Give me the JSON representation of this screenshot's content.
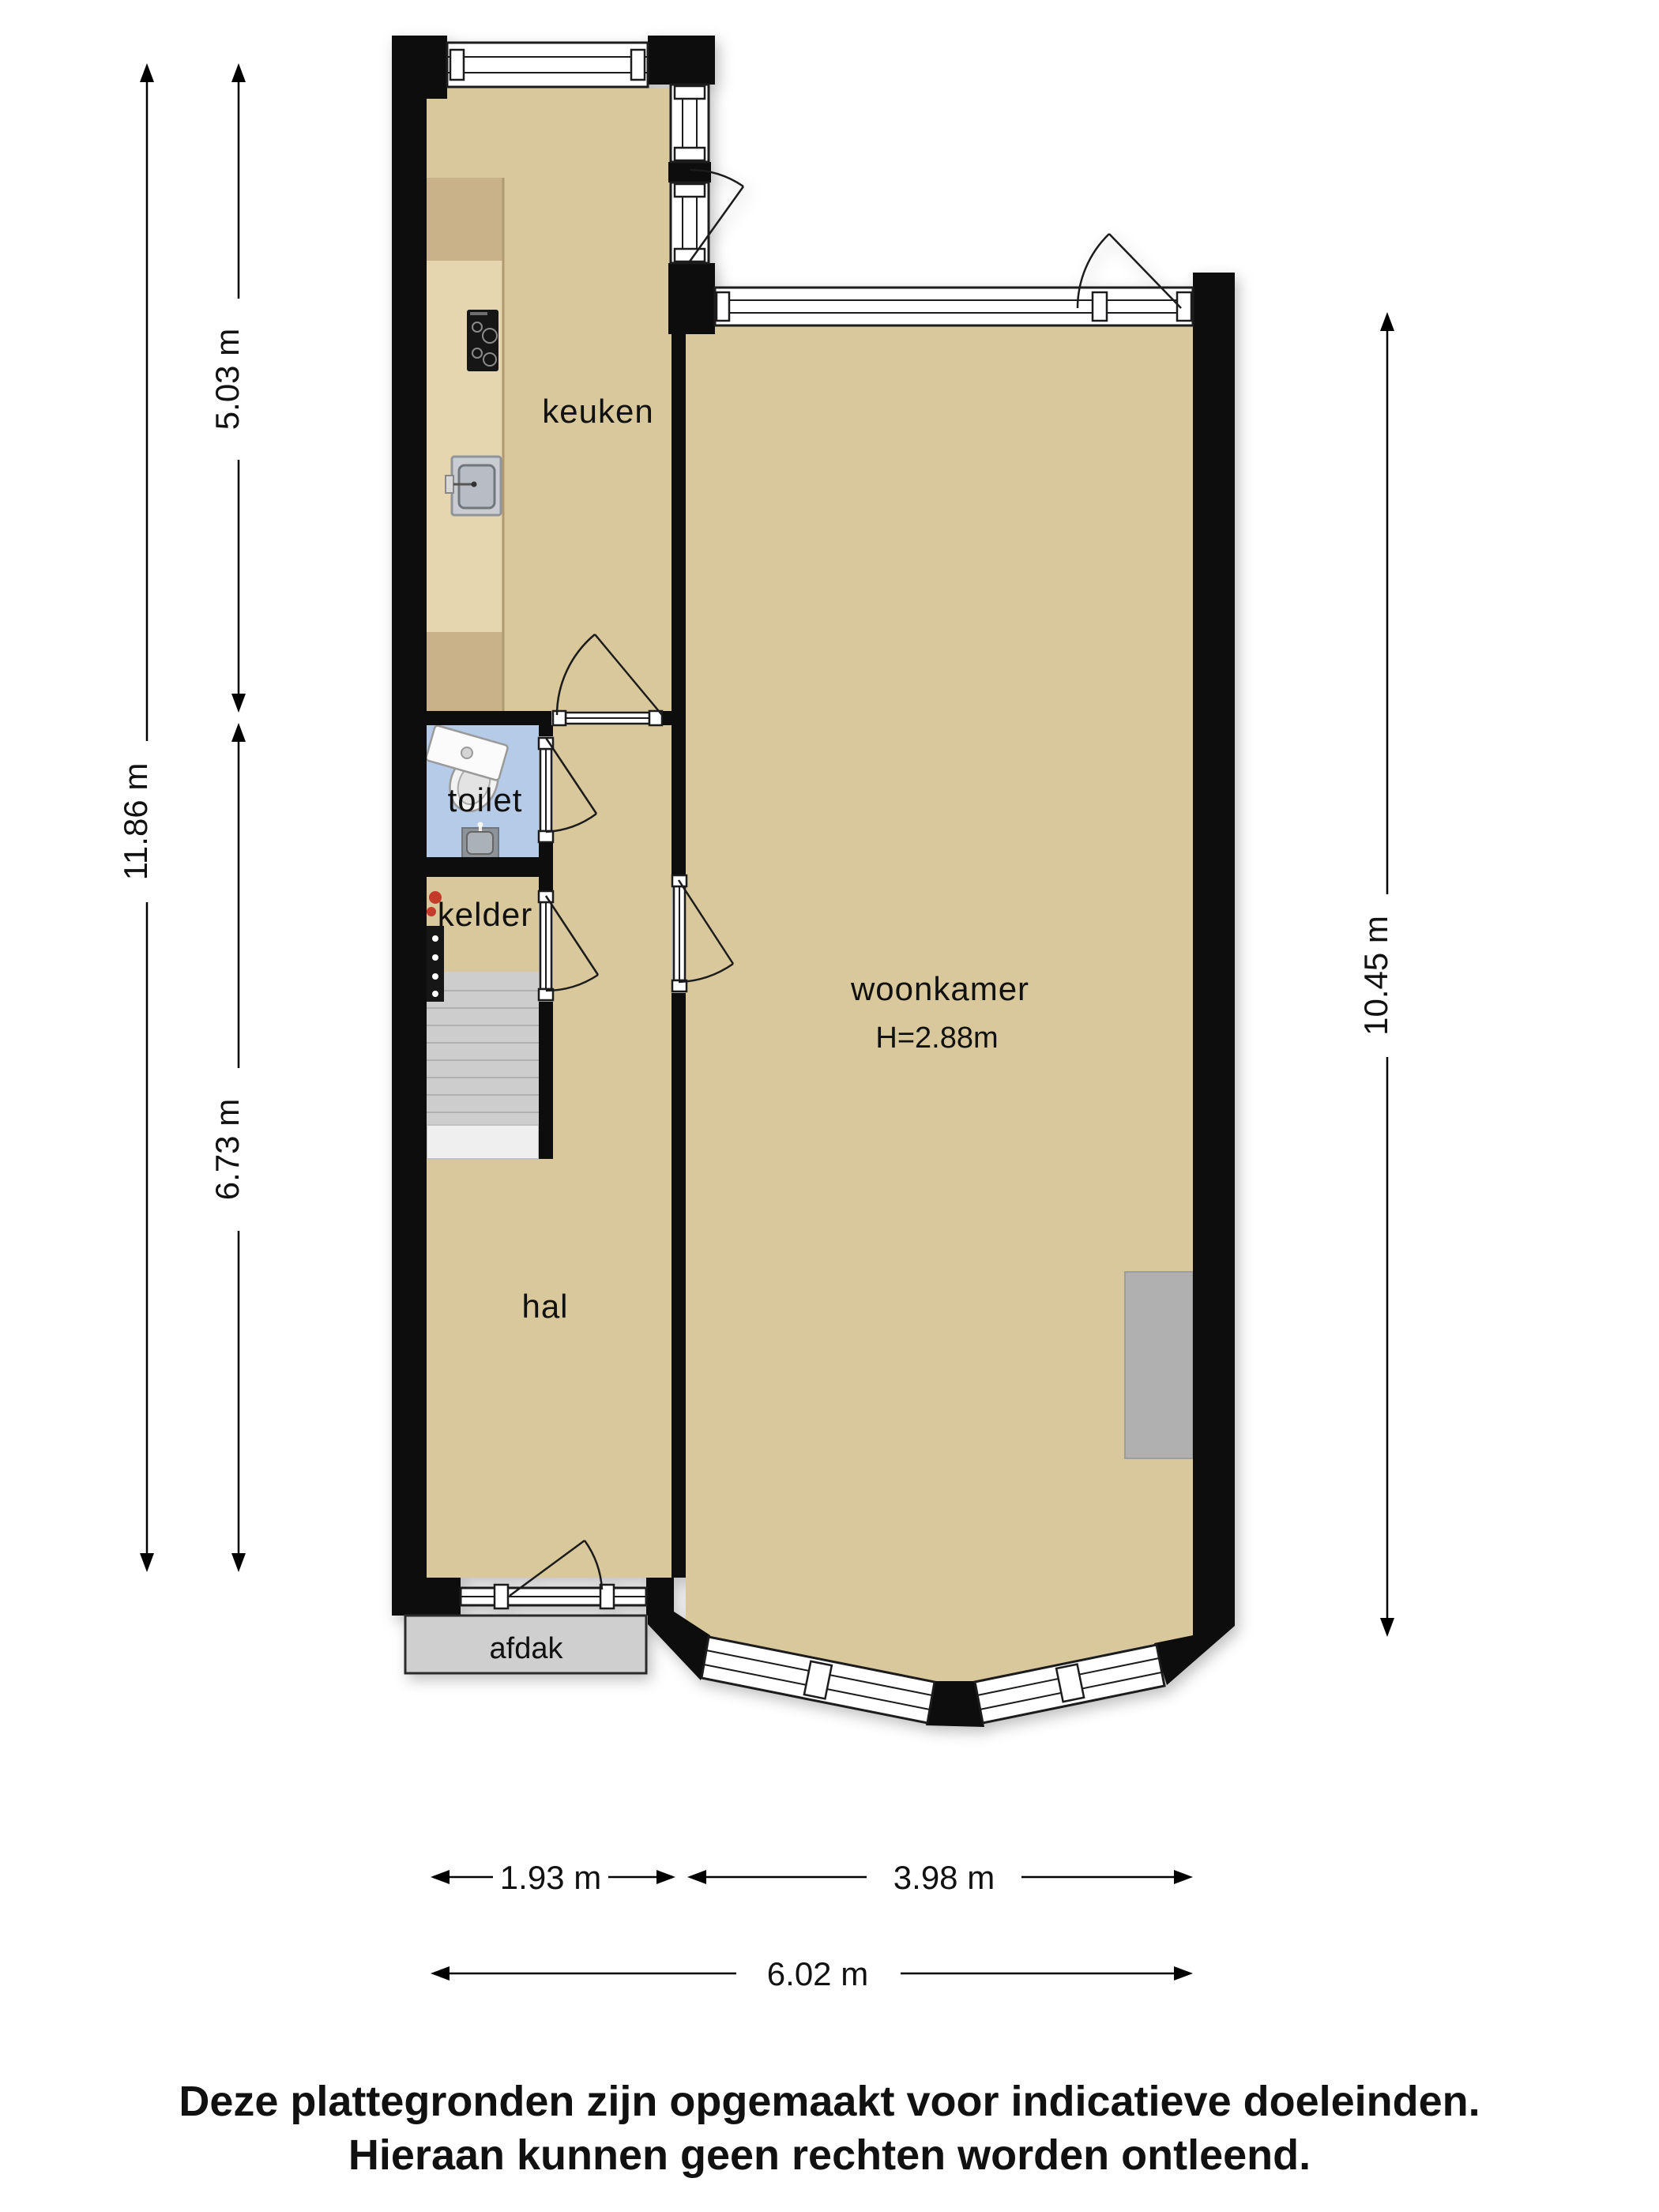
{
  "plan": {
    "rooms": {
      "keuken": "keuken",
      "toilet": "toilet",
      "kelder": "kelder",
      "hal": "hal",
      "woonkamer": "woonkamer",
      "woonkamer_height": "H=2.88m",
      "afdak": "afdak"
    },
    "dimensions": {
      "kitchen_depth": "5.03 m",
      "left_total": "11.86 m",
      "hall_depth": "6.73 m",
      "living_depth": "10.45 m",
      "front_left": "1.93 m",
      "front_right": "3.98 m",
      "front_total": "6.02 m"
    },
    "footer": {
      "line1": "Deze plattegronden zijn opgemaakt voor indicatieve doeleinden.",
      "line2": "Hieraan kunnen geen rechten worden ontleend."
    },
    "colors": {
      "wall": "#070707",
      "floor": "#d9c89c",
      "toilet_floor": "#b6cbe7",
      "stairs": "#cdcdcd",
      "stairs_landing": "#efefef",
      "canopy": "#cfcfcf",
      "counter": "#e6d6b0",
      "counter_dark": "#c9b189",
      "fireplace": "#b0b0b0",
      "cooktop": "#141414",
      "sink": "#b7bdc2",
      "fixture_red": "#c43a2a"
    }
  }
}
